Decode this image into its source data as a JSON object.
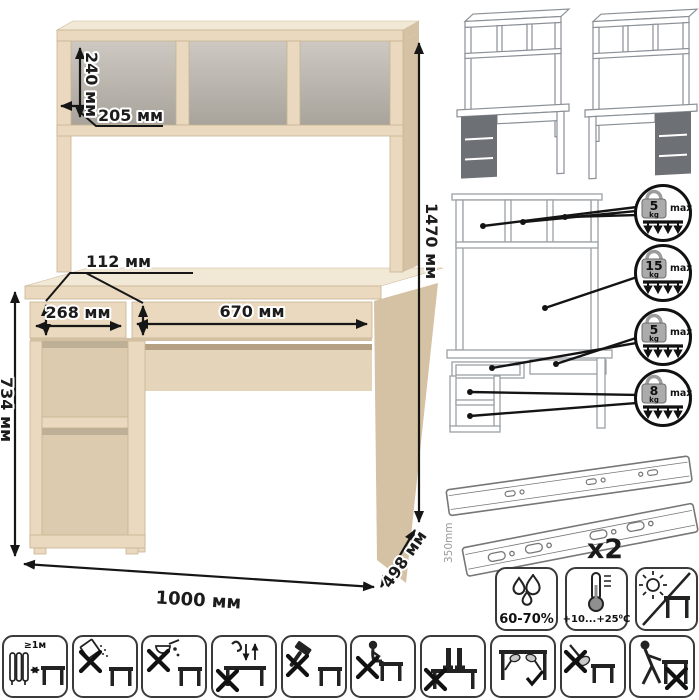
{
  "canvas": {
    "width": 699,
    "height": 700,
    "background": "#ffffff"
  },
  "dimension_diagram": {
    "name": "desk-with-hutch-dimensions",
    "labels": {
      "shelf_inner_height": "240 мм",
      "shelf_depth": "205 мм",
      "total_height": "1470 мм",
      "drawer_front_height": "112 мм",
      "left_drawer_width": "268 мм",
      "right_drawer_width": "670 мм",
      "desk_height": "734 мм",
      "total_width": "1000 мм",
      "total_depth": "498 мм"
    },
    "colors": {
      "body_front": "#ead9bf",
      "body_side": "#d5c1a3",
      "body_top": "#f2e8d6",
      "inner_shade": "#dccbae",
      "back_panel": "#e4d5ba",
      "dimension_lines": "#161616"
    }
  },
  "assembly_variants": {
    "description": "pedestal-left-or-right",
    "highlight_color": "#6d7175",
    "items": [
      {
        "name": "variant-pedestal-left"
      },
      {
        "name": "variant-pedestal-right"
      }
    ]
  },
  "load_limits": {
    "unit_label": "kg",
    "max_label": "max",
    "items": [
      {
        "value": "5",
        "target": "hutch-shelves"
      },
      {
        "value": "15",
        "target": "desktop"
      },
      {
        "value": "5",
        "target": "drawers"
      },
      {
        "value": "8",
        "target": "pedestal-shelves"
      }
    ]
  },
  "hardware": {
    "item": "telescopic-drawer-slides",
    "length_label": "350mm",
    "quantity_label": "x2"
  },
  "environment": {
    "humidity_label": "60-70%",
    "temperature_label": "+10...+25⁰C",
    "sunlight": "avoid-direct-sunlight"
  },
  "care_pictograms": {
    "distance_label": "≥1м",
    "items": [
      {
        "name": "keep-1m-from-heaters"
      },
      {
        "name": "no-abrasive-powders"
      },
      {
        "name": "no-spilling-liquids"
      },
      {
        "name": "no-jumping-on-top"
      },
      {
        "name": "no-hammering"
      },
      {
        "name": "no-sitting-on-top"
      },
      {
        "name": "no-standing-on-top"
      },
      {
        "name": "carry-holding-under-top"
      },
      {
        "name": "no-lifting-by-edge"
      },
      {
        "name": "no-dragging"
      }
    ]
  }
}
